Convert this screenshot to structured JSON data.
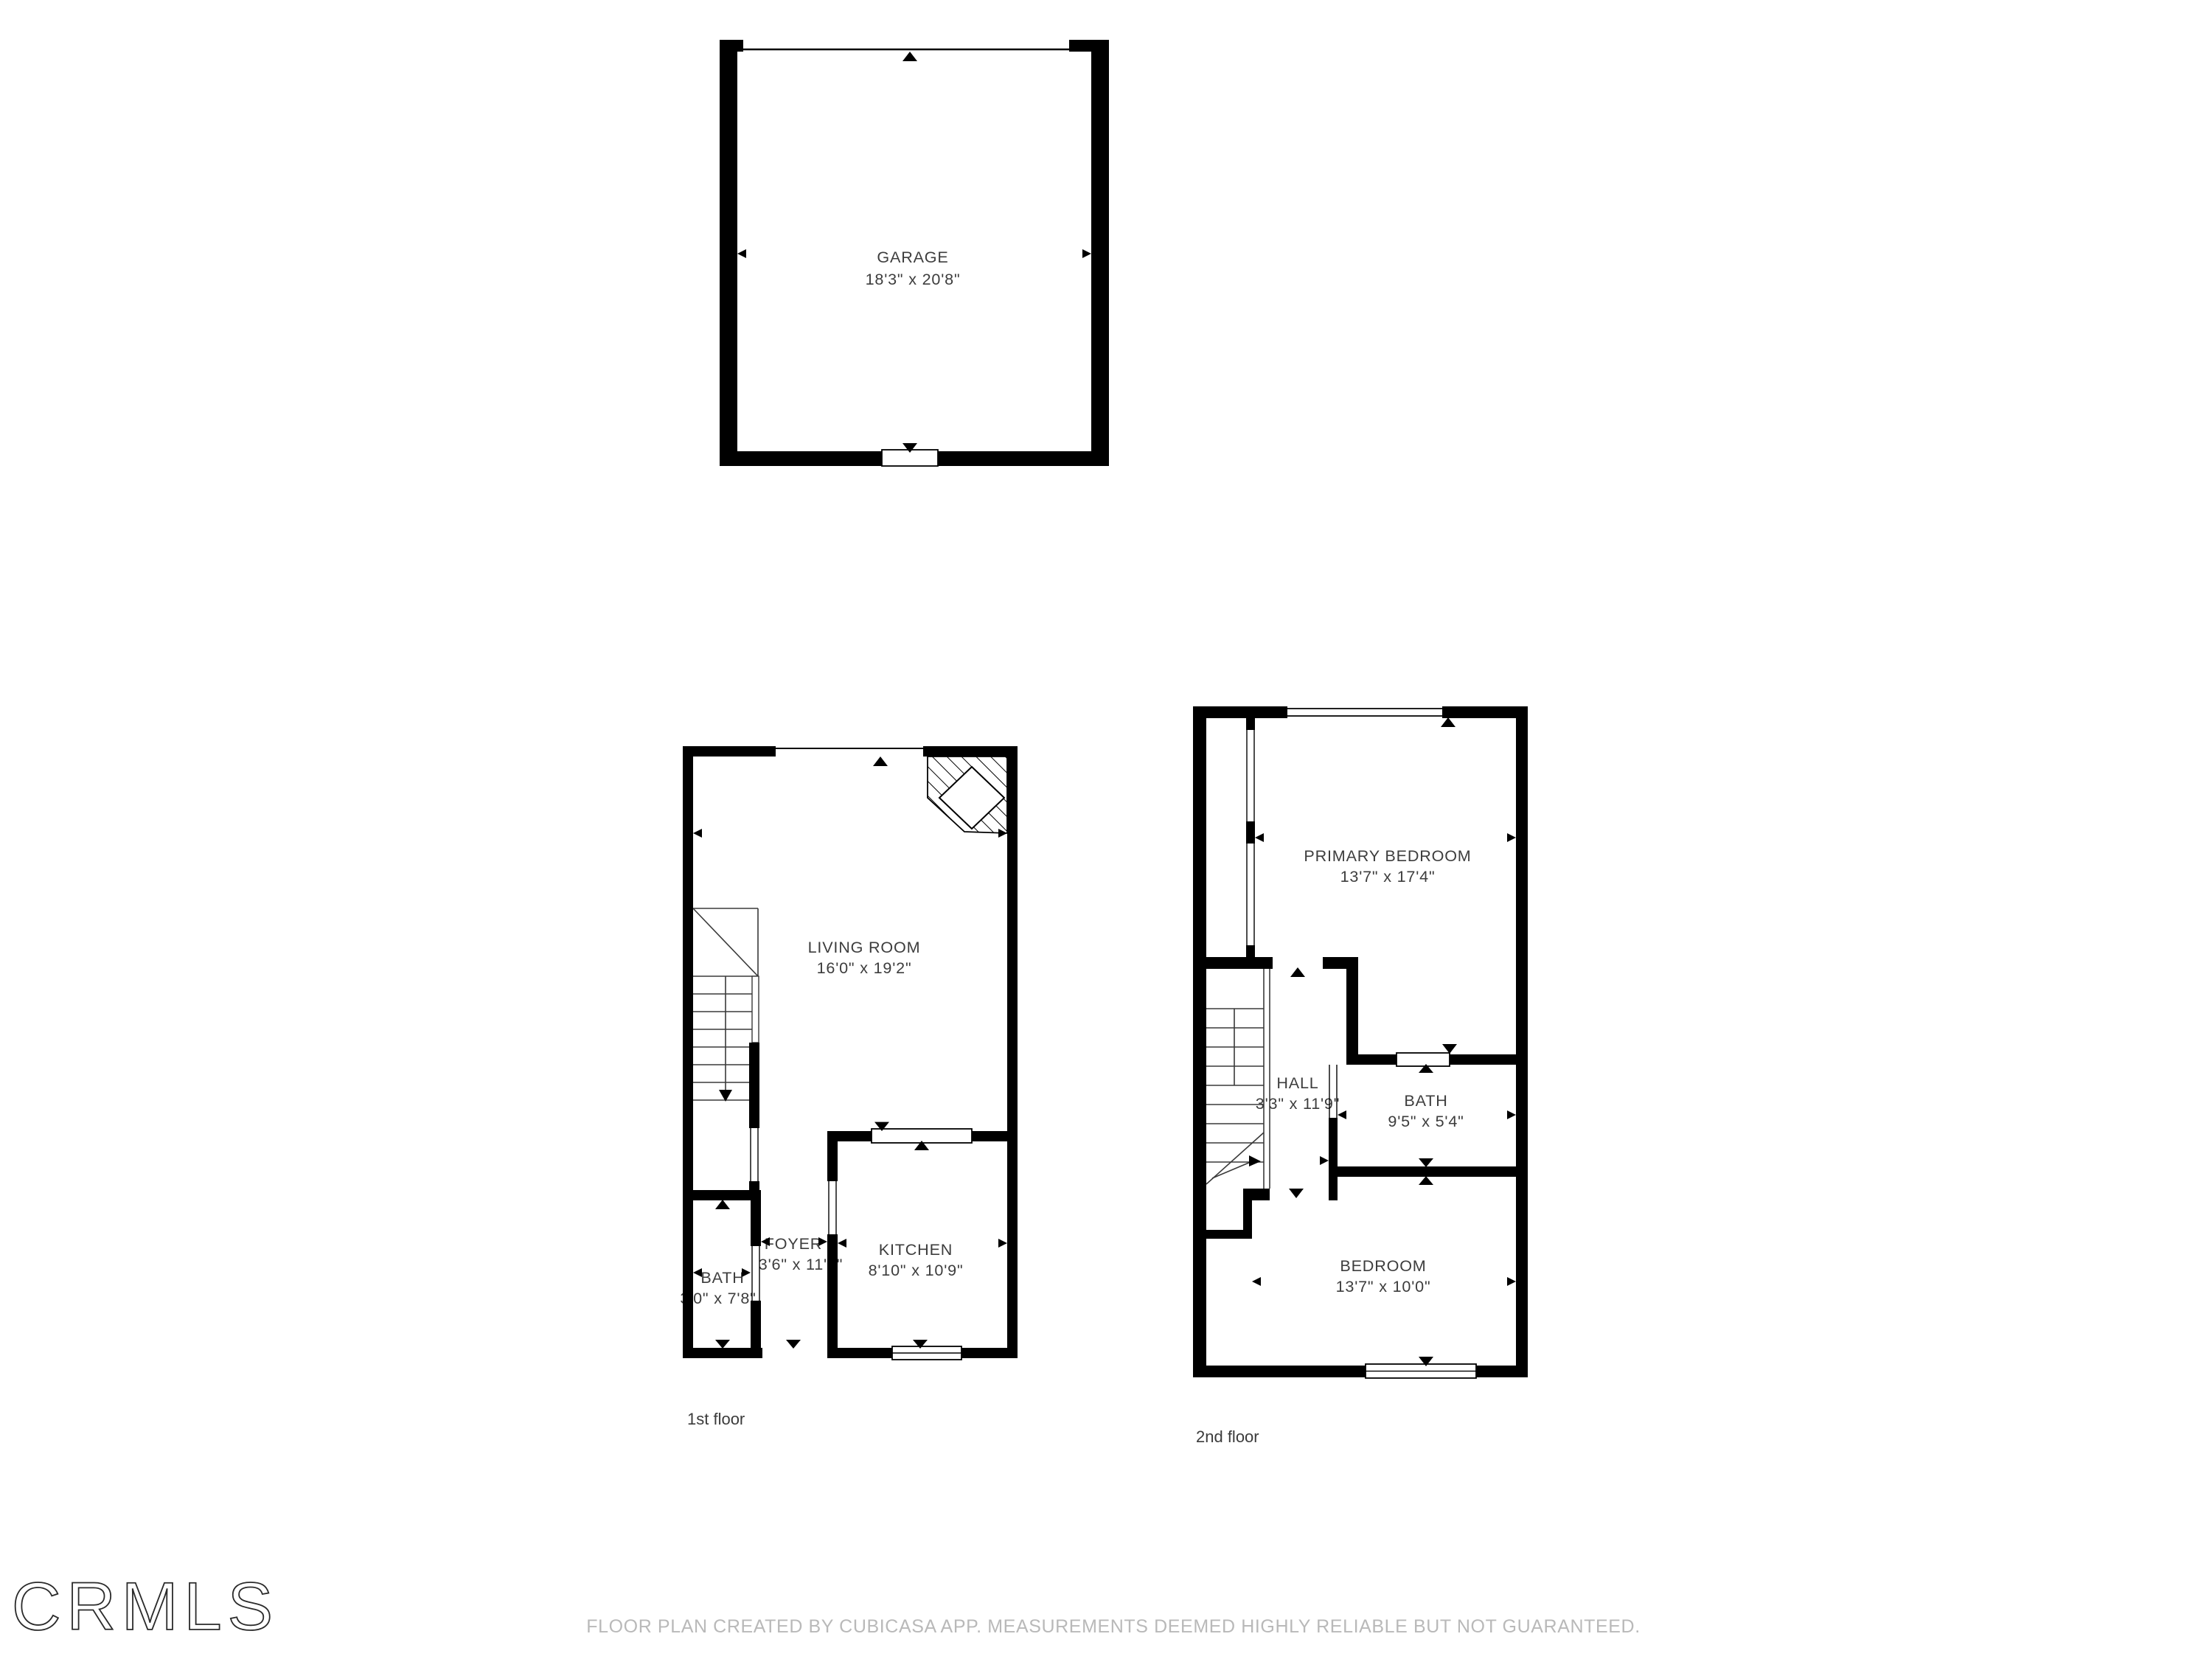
{
  "branding": {
    "logo_text": "CRMLS"
  },
  "footer": {
    "disclaimer": "FLOOR PLAN CREATED BY CUBICASA APP. MEASUREMENTS DEEMED HIGHLY RELIABLE BUT NOT GUARANTEED."
  },
  "colors": {
    "wall": "#000000",
    "label": "#3d3d3d",
    "footer": "#b9b9b9"
  },
  "floors": {
    "garage": {
      "rooms": {
        "garage": {
          "name": "GARAGE",
          "dims": "18'3\" x 20'8\""
        }
      }
    },
    "first": {
      "label": "1st floor",
      "rooms": {
        "living_room": {
          "name": "LIVING ROOM",
          "dims": "16'0\" x 19'2\""
        },
        "foyer": {
          "name": "FOYER",
          "dims": "3'6\" x 11'1\""
        },
        "bath": {
          "name": "BATH",
          "dims": "3'0\" x 7'8\""
        },
        "kitchen": {
          "name": "KITCHEN",
          "dims": "8'10\" x 10'9\""
        }
      }
    },
    "second": {
      "label": "2nd floor",
      "rooms": {
        "primary_bedroom": {
          "name": "PRIMARY BEDROOM",
          "dims": "13'7\" x 17'4\""
        },
        "hall": {
          "name": "HALL",
          "dims": "3'3\" x 11'9\""
        },
        "bath": {
          "name": "BATH",
          "dims": "9'5\" x 5'4\""
        },
        "bedroom": {
          "name": "BEDROOM",
          "dims": "13'7\" x 10'0\""
        }
      }
    }
  }
}
